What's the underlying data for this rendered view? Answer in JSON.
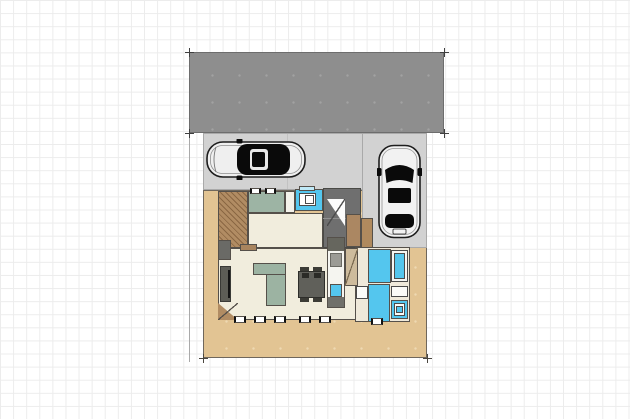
{
  "background": {
    "page_color": "#ffffff",
    "grid_color": "#ececec",
    "grid_size_px": 13.1
  },
  "palette": {
    "roof_gray": "#8e8e8e",
    "pavement_gray": "#d2d2d2",
    "yard_tan": "#e2c493",
    "deck_brown": "#b18c63",
    "wall_dark": "#55504a",
    "floor_cream": "#f1eddd",
    "water_cyan": "#54c6ee",
    "tatami_sage": "#9db4a4",
    "entrance_gray": "#6f6f6f",
    "furniture_dark": "#60605a",
    "fixture_white": "#fbfbf8"
  },
  "scene": {
    "elements": [
      {
        "n": "site-boundary-left-line",
        "t": "vline",
        "x": 189,
        "y": 52,
        "w": 1,
        "h": 310,
        "f": "#a9a9a9"
      },
      {
        "n": "yard-ground",
        "t": "dots",
        "x": 203,
        "y": 190,
        "w": 224,
        "h": 168,
        "f": "#e2c493",
        "b": "#6f675c",
        "dc": "#eed9b2"
      },
      {
        "n": "carport-floor",
        "t": "rect",
        "x": 203,
        "y": 133,
        "w": 224,
        "h": 57,
        "f": "#d2d2d2",
        "b": "#a9a9a9"
      },
      {
        "n": "driveway-strip",
        "t": "rect",
        "x": 362,
        "y": 133,
        "w": 65,
        "h": 115,
        "f": "#d2d2d2",
        "b": "#a9a9a9"
      },
      {
        "n": "carport-divider-line",
        "t": "vline",
        "x": 287,
        "y": 134,
        "w": 1,
        "h": 55,
        "f": "#c2c2c2"
      },
      {
        "n": "carport-roof",
        "t": "dots",
        "x": 189,
        "y": 52,
        "w": 255,
        "h": 81,
        "f": "#8e8e8e",
        "b": "#6d6d6d",
        "dc": "#a2a2a2"
      },
      {
        "n": "roof-corner-mark-nw",
        "t": "cross",
        "x": 189,
        "y": 52,
        "f": "#3f3f3f"
      },
      {
        "n": "roof-corner-mark-ne",
        "t": "cross",
        "x": 444,
        "y": 52,
        "f": "#3f3f3f"
      },
      {
        "n": "roof-corner-mark-sw",
        "t": "cross",
        "x": 189,
        "y": 133,
        "f": "#3f3f3f"
      },
      {
        "n": "roof-corner-mark-se",
        "t": "cross",
        "x": 444,
        "y": 133,
        "f": "#3f3f3f"
      },
      {
        "n": "lot-corner-mark-sw",
        "t": "cross",
        "x": 203,
        "y": 358,
        "f": "#4a463f"
      },
      {
        "n": "lot-corner-mark-se",
        "t": "cross",
        "x": 427,
        "y": 358,
        "f": "#4a463f"
      },
      {
        "n": "entry-deck",
        "t": "hatch",
        "x": 218,
        "y": 191,
        "w": 30,
        "h": 57,
        "f": "#b18c63",
        "b": "#55504a"
      },
      {
        "n": "storage-room",
        "t": "rect",
        "x": 248,
        "y": 191,
        "w": 37,
        "h": 22,
        "f": "#9db4a4",
        "b": "#55504a"
      },
      {
        "n": "small-room",
        "t": "rect",
        "x": 285,
        "y": 191,
        "w": 10,
        "h": 22,
        "f": "#f4f2ea",
        "b": "#55504a"
      },
      {
        "n": "toilet-room",
        "t": "rect",
        "x": 295,
        "y": 189,
        "w": 28,
        "h": 22,
        "f": "#54c6ee",
        "b": "#55504a"
      },
      {
        "n": "toilet-window",
        "t": "rect",
        "x": 299,
        "y": 186,
        "w": 16,
        "h": 5,
        "f": "#bfe9f7",
        "b": "#55504a"
      },
      {
        "n": "toilet-fixture",
        "t": "rect",
        "x": 299,
        "y": 193,
        "w": 17,
        "h": 13,
        "f": "#ffffff",
        "b": "#4a4a4a"
      },
      {
        "n": "toilet-bowl",
        "t": "rect",
        "x": 305,
        "y": 195,
        "w": 9,
        "h": 9,
        "f": "#ffffff",
        "b": "#4a4a4a"
      },
      {
        "n": "entrance-hall",
        "t": "rect",
        "x": 323,
        "y": 188,
        "w": 38,
        "h": 60,
        "f": "#6f6f6f",
        "b": "#4a4a46"
      },
      {
        "n": "entrance-step-line",
        "t": "hline",
        "x": 323,
        "y": 218,
        "w": 38,
        "h": 1,
        "f": "#8f8f8f"
      },
      {
        "n": "entrance-arrow-triangle",
        "t": "tri-ne",
        "x": 327,
        "y": 199,
        "w": 18,
        "h": 27,
        "f": "#fcfcfc"
      },
      {
        "n": "entrance-arrow-diagonal",
        "t": "diag-down",
        "x": 327,
        "y": 199,
        "w": 18,
        "h": 27,
        "f": "#4a4a4a"
      },
      {
        "n": "shoe-cabinet",
        "t": "rect",
        "x": 346,
        "y": 214,
        "w": 15,
        "h": 33,
        "f": "#ab8762",
        "b": "#55504a"
      },
      {
        "n": "corridor",
        "t": "rect",
        "x": 248,
        "y": 213,
        "w": 75,
        "h": 35,
        "f": "#f1eddd",
        "b": "#55504a"
      },
      {
        "n": "porch-side-strip",
        "t": "rect",
        "x": 361,
        "y": 218,
        "w": 12,
        "h": 30,
        "f": "#b08a5e",
        "b": "#55504a"
      },
      {
        "n": "living-dining-room",
        "t": "rect",
        "x": 218,
        "y": 248,
        "w": 143,
        "h": 72,
        "f": "#f1eddd",
        "b": "#55504a"
      },
      {
        "n": "living-door",
        "t": "rect",
        "x": 240,
        "y": 244,
        "w": 17,
        "h": 7,
        "f": "#a8845e",
        "b": "#55504a"
      },
      {
        "n": "tv-wall-corner",
        "t": "rect",
        "x": 218,
        "y": 240,
        "w": 13,
        "h": 20,
        "f": "#6a6a66",
        "b": "#55504a"
      },
      {
        "n": "tv-board",
        "t": "rect",
        "x": 220,
        "y": 266,
        "w": 11,
        "h": 36,
        "f": "#5d5d56",
        "b": "#3a3a36"
      },
      {
        "n": "tv-screen-line",
        "t": "vline",
        "x": 228,
        "y": 270,
        "w": 2,
        "h": 28,
        "f": "#141414"
      },
      {
        "n": "sofa-counter-top",
        "t": "rect",
        "x": 253,
        "y": 263,
        "w": 33,
        "h": 12,
        "f": "#9cb3a2",
        "b": "#55504a"
      },
      {
        "n": "sofa-counter-leg",
        "t": "rect",
        "x": 266,
        "y": 274,
        "w": 20,
        "h": 32,
        "f": "#9cb3a2",
        "b": "#55504a"
      },
      {
        "n": "dining-chair-1",
        "t": "rect",
        "x": 300,
        "y": 267,
        "w": 9,
        "h": 6,
        "f": "#3c3c36"
      },
      {
        "n": "dining-chair-2",
        "t": "rect",
        "x": 313,
        "y": 267,
        "w": 9,
        "h": 6,
        "f": "#3c3c36"
      },
      {
        "n": "dining-chair-3",
        "t": "rect",
        "x": 300,
        "y": 296,
        "w": 9,
        "h": 6,
        "f": "#3c3c36"
      },
      {
        "n": "dining-chair-4",
        "t": "rect",
        "x": 313,
        "y": 296,
        "w": 9,
        "h": 6,
        "f": "#3c3c36"
      },
      {
        "n": "dining-table",
        "t": "rect",
        "x": 298,
        "y": 271,
        "w": 27,
        "h": 27,
        "f": "#60605a",
        "b": "#2e2e2a"
      },
      {
        "n": "table-item-1",
        "t": "rect",
        "x": 302,
        "y": 273,
        "w": 7,
        "h": 5,
        "f": "#2b2b27"
      },
      {
        "n": "table-item-2",
        "t": "rect",
        "x": 314,
        "y": 273,
        "w": 7,
        "h": 5,
        "f": "#2b2b27"
      },
      {
        "n": "kitchen-counter",
        "t": "rect",
        "x": 327,
        "y": 237,
        "w": 18,
        "h": 71,
        "f": "#f5f5f0",
        "b": "#55504a"
      },
      {
        "n": "refrigerator",
        "t": "rect",
        "x": 328,
        "y": 238,
        "w": 16,
        "h": 13,
        "f": "#66665e"
      },
      {
        "n": "kitchen-appliance",
        "t": "rect",
        "x": 330,
        "y": 253,
        "w": 12,
        "h": 14,
        "f": "#9b9b95",
        "b": "#6a6a64"
      },
      {
        "n": "kitchen-sink",
        "t": "rect",
        "x": 330,
        "y": 284,
        "w": 12,
        "h": 13,
        "f": "#54c6ee",
        "b": "#55504a"
      },
      {
        "n": "kitchen-counter-end",
        "t": "rect",
        "x": 328,
        "y": 297,
        "w": 16,
        "h": 10,
        "f": "#70706a"
      },
      {
        "n": "sanitary-area",
        "t": "rect",
        "x": 355,
        "y": 247,
        "w": 55,
        "h": 75,
        "f": "#efe9da",
        "b": "#55504a"
      },
      {
        "n": "sanitary-door-area",
        "t": "rect",
        "x": 345,
        "y": 248,
        "w": 13,
        "h": 38,
        "f": "#cdbb9c",
        "b": "#55504a"
      },
      {
        "n": "sanitary-door-diagonal",
        "t": "diag-down",
        "x": 345,
        "y": 248,
        "w": 13,
        "h": 38,
        "f": "#7a6a50"
      },
      {
        "n": "bathroom-floor",
        "t": "rect",
        "x": 368,
        "y": 249,
        "w": 23,
        "h": 34,
        "f": "#54c6ee",
        "b": "#55504a"
      },
      {
        "n": "bathtub",
        "t": "rect",
        "x": 391,
        "y": 250,
        "w": 17,
        "h": 32,
        "f": "#f6f6f3",
        "b": "#4a4a4a"
      },
      {
        "n": "bathtub-water",
        "t": "rect",
        "x": 394,
        "y": 253,
        "w": 11,
        "h": 26,
        "f": "#54c6ee",
        "b": "#4a4a4a"
      },
      {
        "n": "washroom-floor",
        "t": "rect",
        "x": 368,
        "y": 284,
        "w": 22,
        "h": 38,
        "f": "#54c6ee",
        "b": "#55504a"
      },
      {
        "n": "washing-machine",
        "t": "rect",
        "x": 356,
        "y": 286,
        "w": 12,
        "h": 13,
        "f": "#fbfbf8",
        "b": "#4a4a4a"
      },
      {
        "n": "vanity-counter",
        "t": "rect",
        "x": 391,
        "y": 286,
        "w": 17,
        "h": 11,
        "f": "#fbfbf8",
        "b": "#4a4a4a"
      },
      {
        "n": "shower-unit",
        "t": "rect",
        "x": 391,
        "y": 300,
        "w": 17,
        "h": 19,
        "f": "#54c6ee",
        "b": "#55504a"
      },
      {
        "n": "shower-unit-basin",
        "t": "rect",
        "x": 394,
        "y": 303,
        "w": 11,
        "h": 13,
        "f": "#fbfbf8",
        "b": "#4a4a4a"
      },
      {
        "n": "shower-unit-drain",
        "t": "rect",
        "x": 396,
        "y": 306,
        "w": 7,
        "h": 7,
        "f": "#54c6ee",
        "b": "#4a4a4a"
      },
      {
        "n": "deck-step-triangle",
        "t": "tri-sw",
        "x": 218,
        "y": 303,
        "w": 20,
        "h": 17,
        "f": "#b18c63"
      },
      {
        "n": "deck-step-diagonal",
        "t": "diag-down",
        "x": 218,
        "y": 303,
        "w": 20,
        "h": 17,
        "f": "#55504a"
      },
      {
        "n": "window-south-1",
        "t": "window-h",
        "x": 234,
        "y": 316,
        "w": 12,
        "h": 7
      },
      {
        "n": "window-south-2",
        "t": "window-h",
        "x": 254,
        "y": 316,
        "w": 12,
        "h": 7
      },
      {
        "n": "window-south-3",
        "t": "window-h",
        "x": 274,
        "y": 316,
        "w": 12,
        "h": 7
      },
      {
        "n": "window-south-4",
        "t": "window-h",
        "x": 299,
        "y": 316,
        "w": 12,
        "h": 7
      },
      {
        "n": "window-south-5",
        "t": "window-h",
        "x": 319,
        "y": 316,
        "w": 12,
        "h": 7
      },
      {
        "n": "window-south-6",
        "t": "window-h",
        "x": 371,
        "y": 318,
        "w": 12,
        "h": 7
      },
      {
        "n": "window-north-1",
        "t": "window-h",
        "x": 250,
        "y": 188,
        "w": 11,
        "h": 6
      },
      {
        "n": "window-north-2",
        "t": "window-h",
        "x": 265,
        "y": 188,
        "w": 11,
        "h": 6
      }
    ],
    "cars": [
      {
        "n": "car-left",
        "x": 206,
        "y": 139,
        "w": 101,
        "h": 41,
        "body_color": "#efefef",
        "glass_color": "#0a0a0a",
        "orientation": "horizontal-facing-left"
      },
      {
        "n": "car-right",
        "x": 377,
        "y": 144,
        "w": 45,
        "h": 95,
        "body_color": "#f2f2f2",
        "glass_color": "#0a0a0a",
        "orientation": "vertical-facing-up"
      }
    ]
  }
}
